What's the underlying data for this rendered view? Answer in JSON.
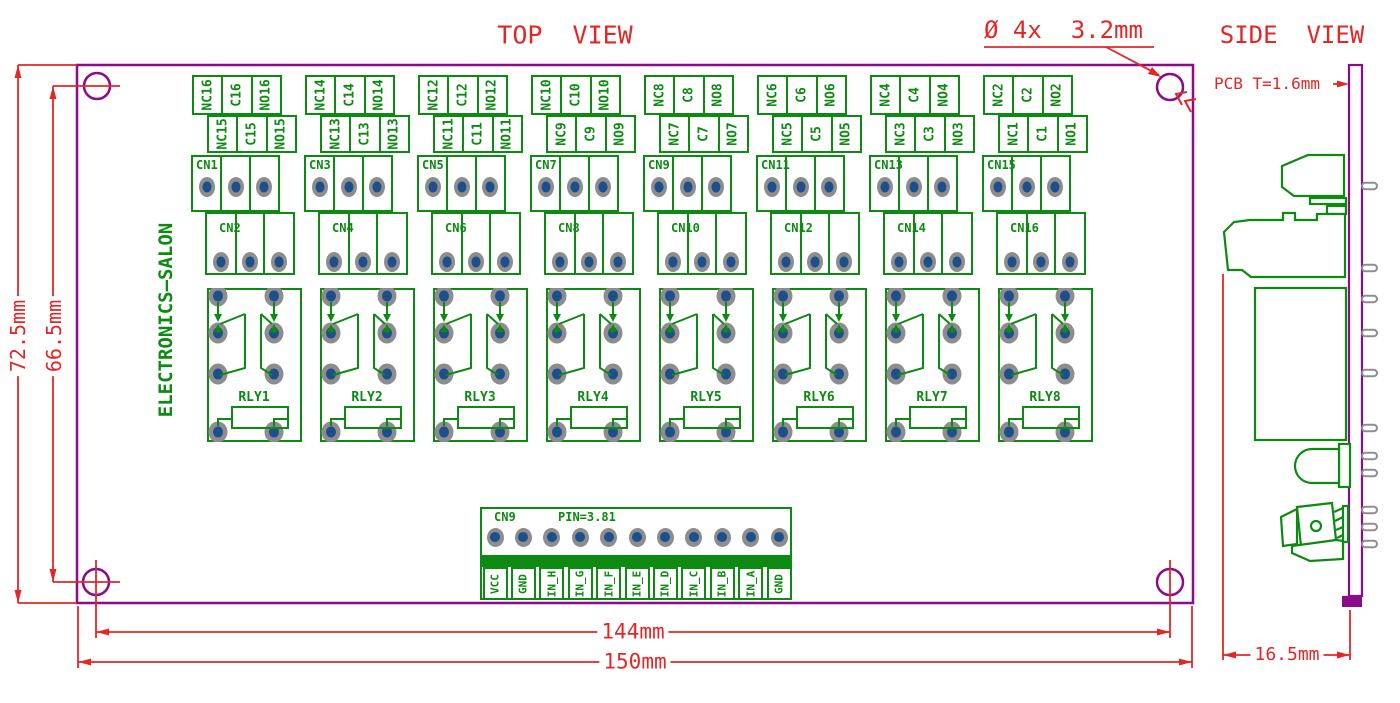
{
  "titles": {
    "top_view": "TOP  VIEW",
    "side_view": "SIDE  VIEW"
  },
  "notes": {
    "hole_diameter": "Ø 4x  3.2mm",
    "pcb_thickness": "PCB T=1.6mm",
    "brand": "ELECTRONICS—SALON"
  },
  "dimensions": {
    "board_height": "72.5mm",
    "hole_span_vertical": "66.5mm",
    "hole_span_horizontal": "144mm",
    "board_width": "150mm",
    "side_depth": "16.5mm"
  },
  "colors": {
    "board_outline": "#8b0b8b",
    "copper_green": "#0d8a12",
    "dimension_red": "#e32726",
    "pad_ring": "#8d8d8d",
    "pad_hole": "#1d4f8c"
  },
  "relay_groups": [
    {
      "relay": "RLY1",
      "upper_connector": "CN1",
      "lower_connector": "CN2",
      "upper_terminals": [
        "NC16",
        "C16",
        "NO16"
      ],
      "lower_terminals": [
        "NC15",
        "C15",
        "NO15"
      ]
    },
    {
      "relay": "RLY2",
      "upper_connector": "CN3",
      "lower_connector": "CN4",
      "upper_terminals": [
        "NC14",
        "C14",
        "NO14"
      ],
      "lower_terminals": [
        "NC13",
        "C13",
        "NO13"
      ]
    },
    {
      "relay": "RLY3",
      "upper_connector": "CN5",
      "lower_connector": "CN6",
      "upper_terminals": [
        "NC12",
        "C12",
        "NO12"
      ],
      "lower_terminals": [
        "NC11",
        "C11",
        "NO11"
      ]
    },
    {
      "relay": "RLY4",
      "upper_connector": "CN7",
      "lower_connector": "CN8",
      "upper_terminals": [
        "NC10",
        "C10",
        "NO10"
      ],
      "lower_terminals": [
        "NC9",
        "C9",
        "NO9"
      ]
    },
    {
      "relay": "RLY5",
      "upper_connector": "CN9",
      "lower_connector": "CN10",
      "upper_terminals": [
        "NC8",
        "C8",
        "NO8"
      ],
      "lower_terminals": [
        "NC7",
        "C7",
        "NO7"
      ]
    },
    {
      "relay": "RLY6",
      "upper_connector": "CN11",
      "lower_connector": "CN12",
      "upper_terminals": [
        "NC6",
        "C6",
        "NO6"
      ],
      "lower_terminals": [
        "NC5",
        "C5",
        "NO5"
      ]
    },
    {
      "relay": "RLY7",
      "upper_connector": "CN13",
      "lower_connector": "CN14",
      "upper_terminals": [
        "NC4",
        "C4",
        "NO4"
      ],
      "lower_terminals": [
        "NC3",
        "C3",
        "NO3"
      ]
    },
    {
      "relay": "RLY8",
      "upper_connector": "CN15",
      "lower_connector": "CN16",
      "upper_terminals": [
        "NC2",
        "C2",
        "NO2"
      ],
      "lower_terminals": [
        "NC1",
        "C1",
        "NO1"
      ]
    }
  ],
  "input_connector": {
    "name": "CN9",
    "pitch_note": "PIN=3.81",
    "pins": [
      "VCC",
      "GND",
      "IN_H",
      "IN_G",
      "IN_F",
      "IN_E",
      "IN_D",
      "IN_C",
      "IN_B",
      "IN_A",
      "GND"
    ]
  }
}
